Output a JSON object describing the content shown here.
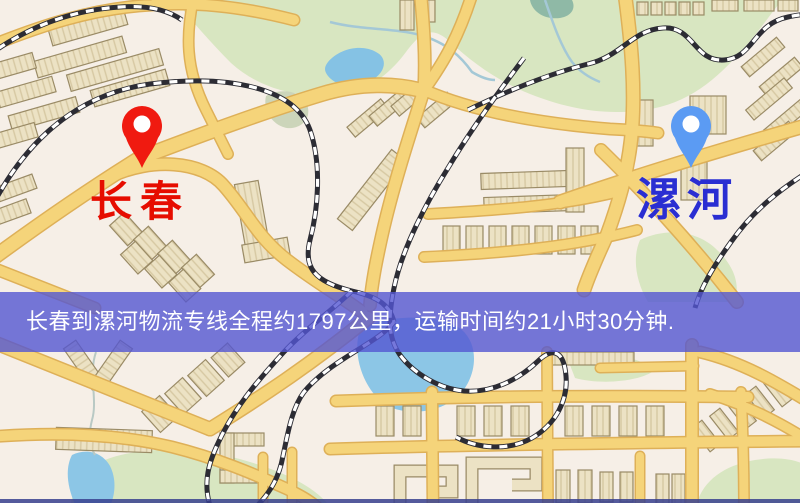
{
  "banner": {
    "text": "长春到漯河物流专线全程约1797公里，运输时间约21小时30分钟.",
    "background": "#5456d2",
    "text_color": "#ffffff"
  },
  "markers": {
    "origin": {
      "label": "长春",
      "pin_icon": "location-pin",
      "pin_color": "#f01a10",
      "label_color": "#e60d00"
    },
    "destination": {
      "label": "漯河",
      "pin_icon": "location-pin",
      "pin_color": "#5b9bf3",
      "label_color": "#2a2ed2"
    }
  },
  "map": {
    "colors": {
      "background": "#f6efe7",
      "road": "#f5d47a",
      "road_casing": "#deb058",
      "park": "#d8e6c1",
      "water": "#85c2e4",
      "building": "#ece2c4",
      "railway": "#2c2c34"
    }
  }
}
